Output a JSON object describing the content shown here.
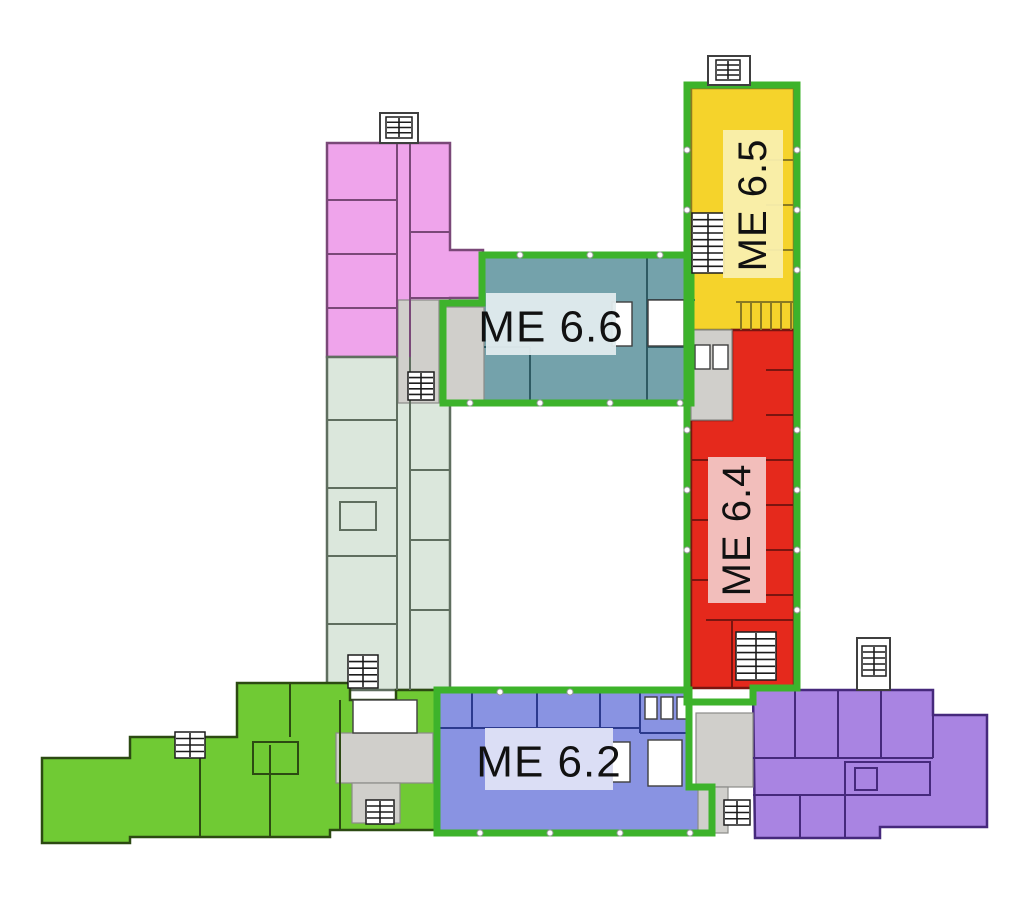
{
  "figure": {
    "type": "floor-plan",
    "width": 1024,
    "height": 899,
    "background": "#ffffff",
    "visible_labels": [
      "ME 6.6",
      "ME 6.5",
      "ME 6.4",
      "ME 6.2"
    ]
  },
  "palette": {
    "zone_border_green": "#3db32b",
    "lobby_grey": "#d0cfcb",
    "lobby_stroke": "#8b8b88",
    "outline_dark": "#3f3f3f",
    "stair_dark": "#1c1c1c",
    "label_text": "#111111",
    "fixture_white": "#ffffff",
    "dot_stroke": "#999999"
  },
  "zones": [
    {
      "id": "northwest-wing",
      "label": null,
      "fill": "#efa4eb",
      "wall": "#7a4878",
      "polygon": [
        [
          327,
          143
        ],
        [
          450,
          143
        ],
        [
          450,
          250
        ],
        [
          483,
          250
        ],
        [
          483,
          298
        ],
        [
          450,
          298
        ],
        [
          450,
          357
        ],
        [
          327,
          357
        ]
      ]
    },
    {
      "id": "west-wing-lower",
      "label": null,
      "fill": "#dbe7dc",
      "wall": "#5f6e5f",
      "polygon": [
        [
          327,
          357
        ],
        [
          450,
          357
        ],
        [
          450,
          690
        ],
        [
          327,
          690
        ]
      ]
    },
    {
      "id": "me66",
      "label": "ME 6.6",
      "fill": "#74a2ab",
      "wall": "#2e5a63",
      "polygon": [
        [
          443,
          305
        ],
        [
          482,
          305
        ],
        [
          482,
          257
        ],
        [
          695,
          257
        ],
        [
          695,
          403
        ],
        [
          443,
          403
        ]
      ],
      "band": {
        "x": 486,
        "y": 293,
        "w": 130,
        "h": 62,
        "fill": "#e2ecee",
        "cx": 551,
        "cy": 327,
        "size": 44,
        "rotate": false
      }
    },
    {
      "id": "me65",
      "label": "ME 6.5",
      "fill": "#f5d32b",
      "wall": "#8a7a22",
      "polygon": [
        [
          691,
          88
        ],
        [
          794,
          88
        ],
        [
          794,
          330
        ],
        [
          691,
          330
        ]
      ],
      "band": {
        "x": 723,
        "y": 130,
        "w": 60,
        "h": 148,
        "fill": "#f9efae",
        "cx": 753,
        "cy": 205,
        "size": 40,
        "rotate": true
      }
    },
    {
      "id": "me64",
      "label": "ME 6.4",
      "fill": "#e5291c",
      "wall": "#7a1510",
      "polygon": [
        [
          732,
          330
        ],
        [
          794,
          330
        ],
        [
          794,
          688
        ],
        [
          691,
          688
        ],
        [
          691,
          420
        ],
        [
          732,
          420
        ]
      ],
      "band": {
        "x": 708,
        "y": 457,
        "w": 58,
        "h": 146,
        "fill": "#f2c6c4",
        "cx": 737,
        "cy": 530,
        "size": 40,
        "rotate": true
      }
    },
    {
      "id": "me62",
      "label": "ME 6.2",
      "fill": "#8993e2",
      "wall": "#2c3a8e",
      "polygon": [
        [
          437,
          692
        ],
        [
          689,
          692
        ],
        [
          689,
          787
        ],
        [
          712,
          787
        ],
        [
          712,
          833
        ],
        [
          437,
          833
        ]
      ],
      "band": {
        "x": 485,
        "y": 728,
        "w": 128,
        "h": 62,
        "fill": "#dfe2f6",
        "cx": 549,
        "cy": 762,
        "size": 44,
        "rotate": false
      }
    },
    {
      "id": "southwest-wing",
      "label": null,
      "fill": "#70ca34",
      "wall": "#2c4a12",
      "polygon": [
        [
          42,
          758
        ],
        [
          130,
          758
        ],
        [
          130,
          737
        ],
        [
          237,
          737
        ],
        [
          237,
          683
        ],
        [
          350,
          683
        ],
        [
          350,
          700
        ],
        [
          396,
          700
        ],
        [
          396,
          690
        ],
        [
          437,
          690
        ],
        [
          437,
          830
        ],
        [
          330,
          830
        ],
        [
          330,
          837
        ],
        [
          130,
          837
        ],
        [
          130,
          843
        ],
        [
          42,
          843
        ]
      ]
    },
    {
      "id": "southeast-wing",
      "label": null,
      "fill": "#a984e2",
      "wall": "#46297c",
      "polygon": [
        [
          753,
          690
        ],
        [
          933,
          690
        ],
        [
          933,
          715
        ],
        [
          987,
          715
        ],
        [
          987,
          827
        ],
        [
          880,
          827
        ],
        [
          880,
          838
        ],
        [
          755,
          838
        ]
      ]
    }
  ],
  "green_borders": [
    {
      "id": "me66",
      "points": [
        [
          443,
          303
        ],
        [
          482,
          303
        ],
        [
          482,
          255
        ],
        [
          691,
          255
        ],
        [
          691,
          403
        ],
        [
          443,
          403
        ]
      ]
    },
    {
      "id": "east-wing",
      "points": [
        [
          687,
          85
        ],
        [
          797,
          85
        ],
        [
          797,
          688
        ],
        [
          753,
          688
        ],
        [
          753,
          702
        ],
        [
          687,
          702
        ]
      ]
    },
    {
      "id": "me62",
      "points": [
        [
          437,
          690
        ],
        [
          689,
          690
        ],
        [
          689,
          787
        ],
        [
          712,
          787
        ],
        [
          712,
          833
        ],
        [
          437,
          833
        ]
      ]
    }
  ],
  "lobbies": [
    [
      398,
      300,
      41,
      103
    ],
    [
      443,
      307,
      41,
      96
    ],
    [
      691,
      330,
      41,
      90
    ],
    [
      336,
      733,
      97,
      50
    ],
    [
      352,
      783,
      48,
      40
    ],
    [
      696,
      713,
      57,
      74
    ],
    [
      698,
      787,
      30,
      46
    ]
  ],
  "stair_bumps": [
    [
      380,
      113,
      38,
      30
    ],
    [
      708,
      56,
      42,
      29
    ],
    [
      857,
      638,
      33,
      52
    ]
  ],
  "stairs": [
    [
      386,
      117,
      26,
      21
    ],
    [
      716,
      60,
      24,
      20
    ],
    [
      692,
      213,
      32,
      60
    ],
    [
      736,
      632,
      40,
      48
    ],
    [
      408,
      372,
      26,
      28
    ],
    [
      348,
      655,
      30,
      33
    ],
    [
      175,
      732,
      30,
      26
    ],
    [
      366,
      800,
      28,
      24
    ],
    [
      724,
      800,
      26,
      25
    ],
    [
      862,
      646,
      24,
      30
    ]
  ],
  "wall_groups": [
    {
      "stroke": "#7a4878",
      "segments": [
        [
          327,
          200,
          397,
          200
        ],
        [
          327,
          254,
          397,
          254
        ],
        [
          327,
          308,
          397,
          308
        ],
        [
          397,
          143,
          397,
          357
        ],
        [
          410,
          143,
          410,
          357
        ],
        [
          410,
          232,
          450,
          232
        ],
        [
          410,
          298,
          450,
          298
        ]
      ]
    },
    {
      "stroke": "#5f6e5f",
      "segments": [
        [
          327,
          420,
          397,
          420
        ],
        [
          327,
          488,
          397,
          488
        ],
        [
          327,
          556,
          397,
          556
        ],
        [
          327,
          624,
          397,
          624
        ],
        [
          397,
          357,
          397,
          690
        ],
        [
          410,
          357,
          410,
          690
        ],
        [
          410,
          470,
          450,
          470
        ],
        [
          410,
          540,
          450,
          540
        ],
        [
          410,
          610,
          450,
          610
        ]
      ]
    },
    {
      "stroke": "#2e5a63",
      "segments": [
        [
          647,
          257,
          647,
          403
        ],
        [
          647,
          300,
          695,
          300
        ],
        [
          647,
          347,
          695,
          347
        ],
        [
          530,
          347,
          530,
          403
        ],
        [
          484,
          347,
          530,
          347
        ]
      ]
    },
    {
      "stroke": "#8a7a22",
      "segments": [
        [
          766,
          160,
          794,
          160
        ],
        [
          766,
          205,
          794,
          205
        ],
        [
          766,
          250,
          794,
          250
        ],
        [
          736,
          302,
          794,
          302
        ],
        [
          741,
          302,
          741,
          330
        ],
        [
          751,
          302,
          751,
          330
        ],
        [
          761,
          302,
          761,
          330
        ],
        [
          771,
          302,
          771,
          330
        ],
        [
          781,
          302,
          781,
          330
        ],
        [
          791,
          302,
          791,
          330
        ]
      ]
    },
    {
      "stroke": "#7a1510",
      "segments": [
        [
          766,
          370,
          794,
          370
        ],
        [
          766,
          415,
          794,
          415
        ],
        [
          766,
          460,
          794,
          460
        ],
        [
          766,
          505,
          794,
          505
        ],
        [
          766,
          550,
          794,
          550
        ],
        [
          766,
          595,
          794,
          595
        ],
        [
          691,
          460,
          708,
          460
        ],
        [
          691,
          520,
          708,
          520
        ],
        [
          691,
          580,
          708,
          580
        ],
        [
          706,
          620,
          794,
          620
        ],
        [
          732,
          620,
          732,
          688
        ]
      ]
    },
    {
      "stroke": "#2c3a8e",
      "segments": [
        [
          437,
          728,
          640,
          728
        ],
        [
          472,
          692,
          472,
          728
        ],
        [
          537,
          692,
          537,
          728
        ],
        [
          600,
          692,
          600,
          728
        ],
        [
          640,
          692,
          640,
          733
        ],
        [
          640,
          733,
          689,
          733
        ]
      ]
    },
    {
      "stroke": "#2c4a12",
      "segments": [
        [
          290,
          683,
          290,
          737
        ],
        [
          340,
          700,
          340,
          737
        ],
        [
          200,
          745,
          200,
          837
        ],
        [
          270,
          745,
          270,
          837
        ],
        [
          340,
          737,
          340,
          830
        ]
      ]
    },
    {
      "stroke": "#46297c",
      "segments": [
        [
          753,
          758,
          933,
          758
        ],
        [
          795,
          690,
          795,
          758
        ],
        [
          838,
          690,
          838,
          758
        ],
        [
          881,
          690,
          881,
          758
        ],
        [
          753,
          795,
          880,
          795
        ],
        [
          800,
          795,
          800,
          838
        ],
        [
          845,
          795,
          845,
          838
        ],
        [
          933,
          715,
          933,
          758
        ]
      ]
    }
  ],
  "room_outlines": [
    [
      340,
      502,
      36,
      28,
      "#5f6e5f"
    ],
    [
      253,
      742,
      45,
      32,
      "#2c4a12"
    ],
    [
      845,
      762,
      85,
      33,
      "#46297c"
    ],
    [
      855,
      768,
      22,
      22,
      "#46297c"
    ]
  ],
  "fixtures_white": [
    [
      612,
      302,
      20,
      44
    ],
    [
      648,
      300,
      36,
      46
    ],
    [
      612,
      742,
      18,
      40
    ],
    [
      648,
      740,
      34,
      46
    ],
    [
      695,
      345,
      15,
      24
    ],
    [
      713,
      345,
      15,
      24
    ],
    [
      645,
      697,
      12,
      22
    ],
    [
      661,
      697,
      12,
      22
    ],
    [
      677,
      697,
      12,
      22
    ],
    [
      353,
      700,
      64,
      33
    ]
  ],
  "dots": [
    [
      520,
      255
    ],
    [
      590,
      255
    ],
    [
      660,
      255
    ],
    [
      470,
      403
    ],
    [
      540,
      403
    ],
    [
      610,
      403
    ],
    [
      680,
      403
    ],
    [
      687,
      150
    ],
    [
      687,
      210
    ],
    [
      687,
      430
    ],
    [
      687,
      490
    ],
    [
      687,
      550
    ],
    [
      797,
      150
    ],
    [
      797,
      210
    ],
    [
      797,
      270
    ],
    [
      797,
      430
    ],
    [
      797,
      490
    ],
    [
      797,
      550
    ],
    [
      797,
      610
    ],
    [
      500,
      692
    ],
    [
      570,
      692
    ],
    [
      480,
      833
    ],
    [
      550,
      833
    ],
    [
      620,
      833
    ],
    [
      690,
      833
    ]
  ]
}
